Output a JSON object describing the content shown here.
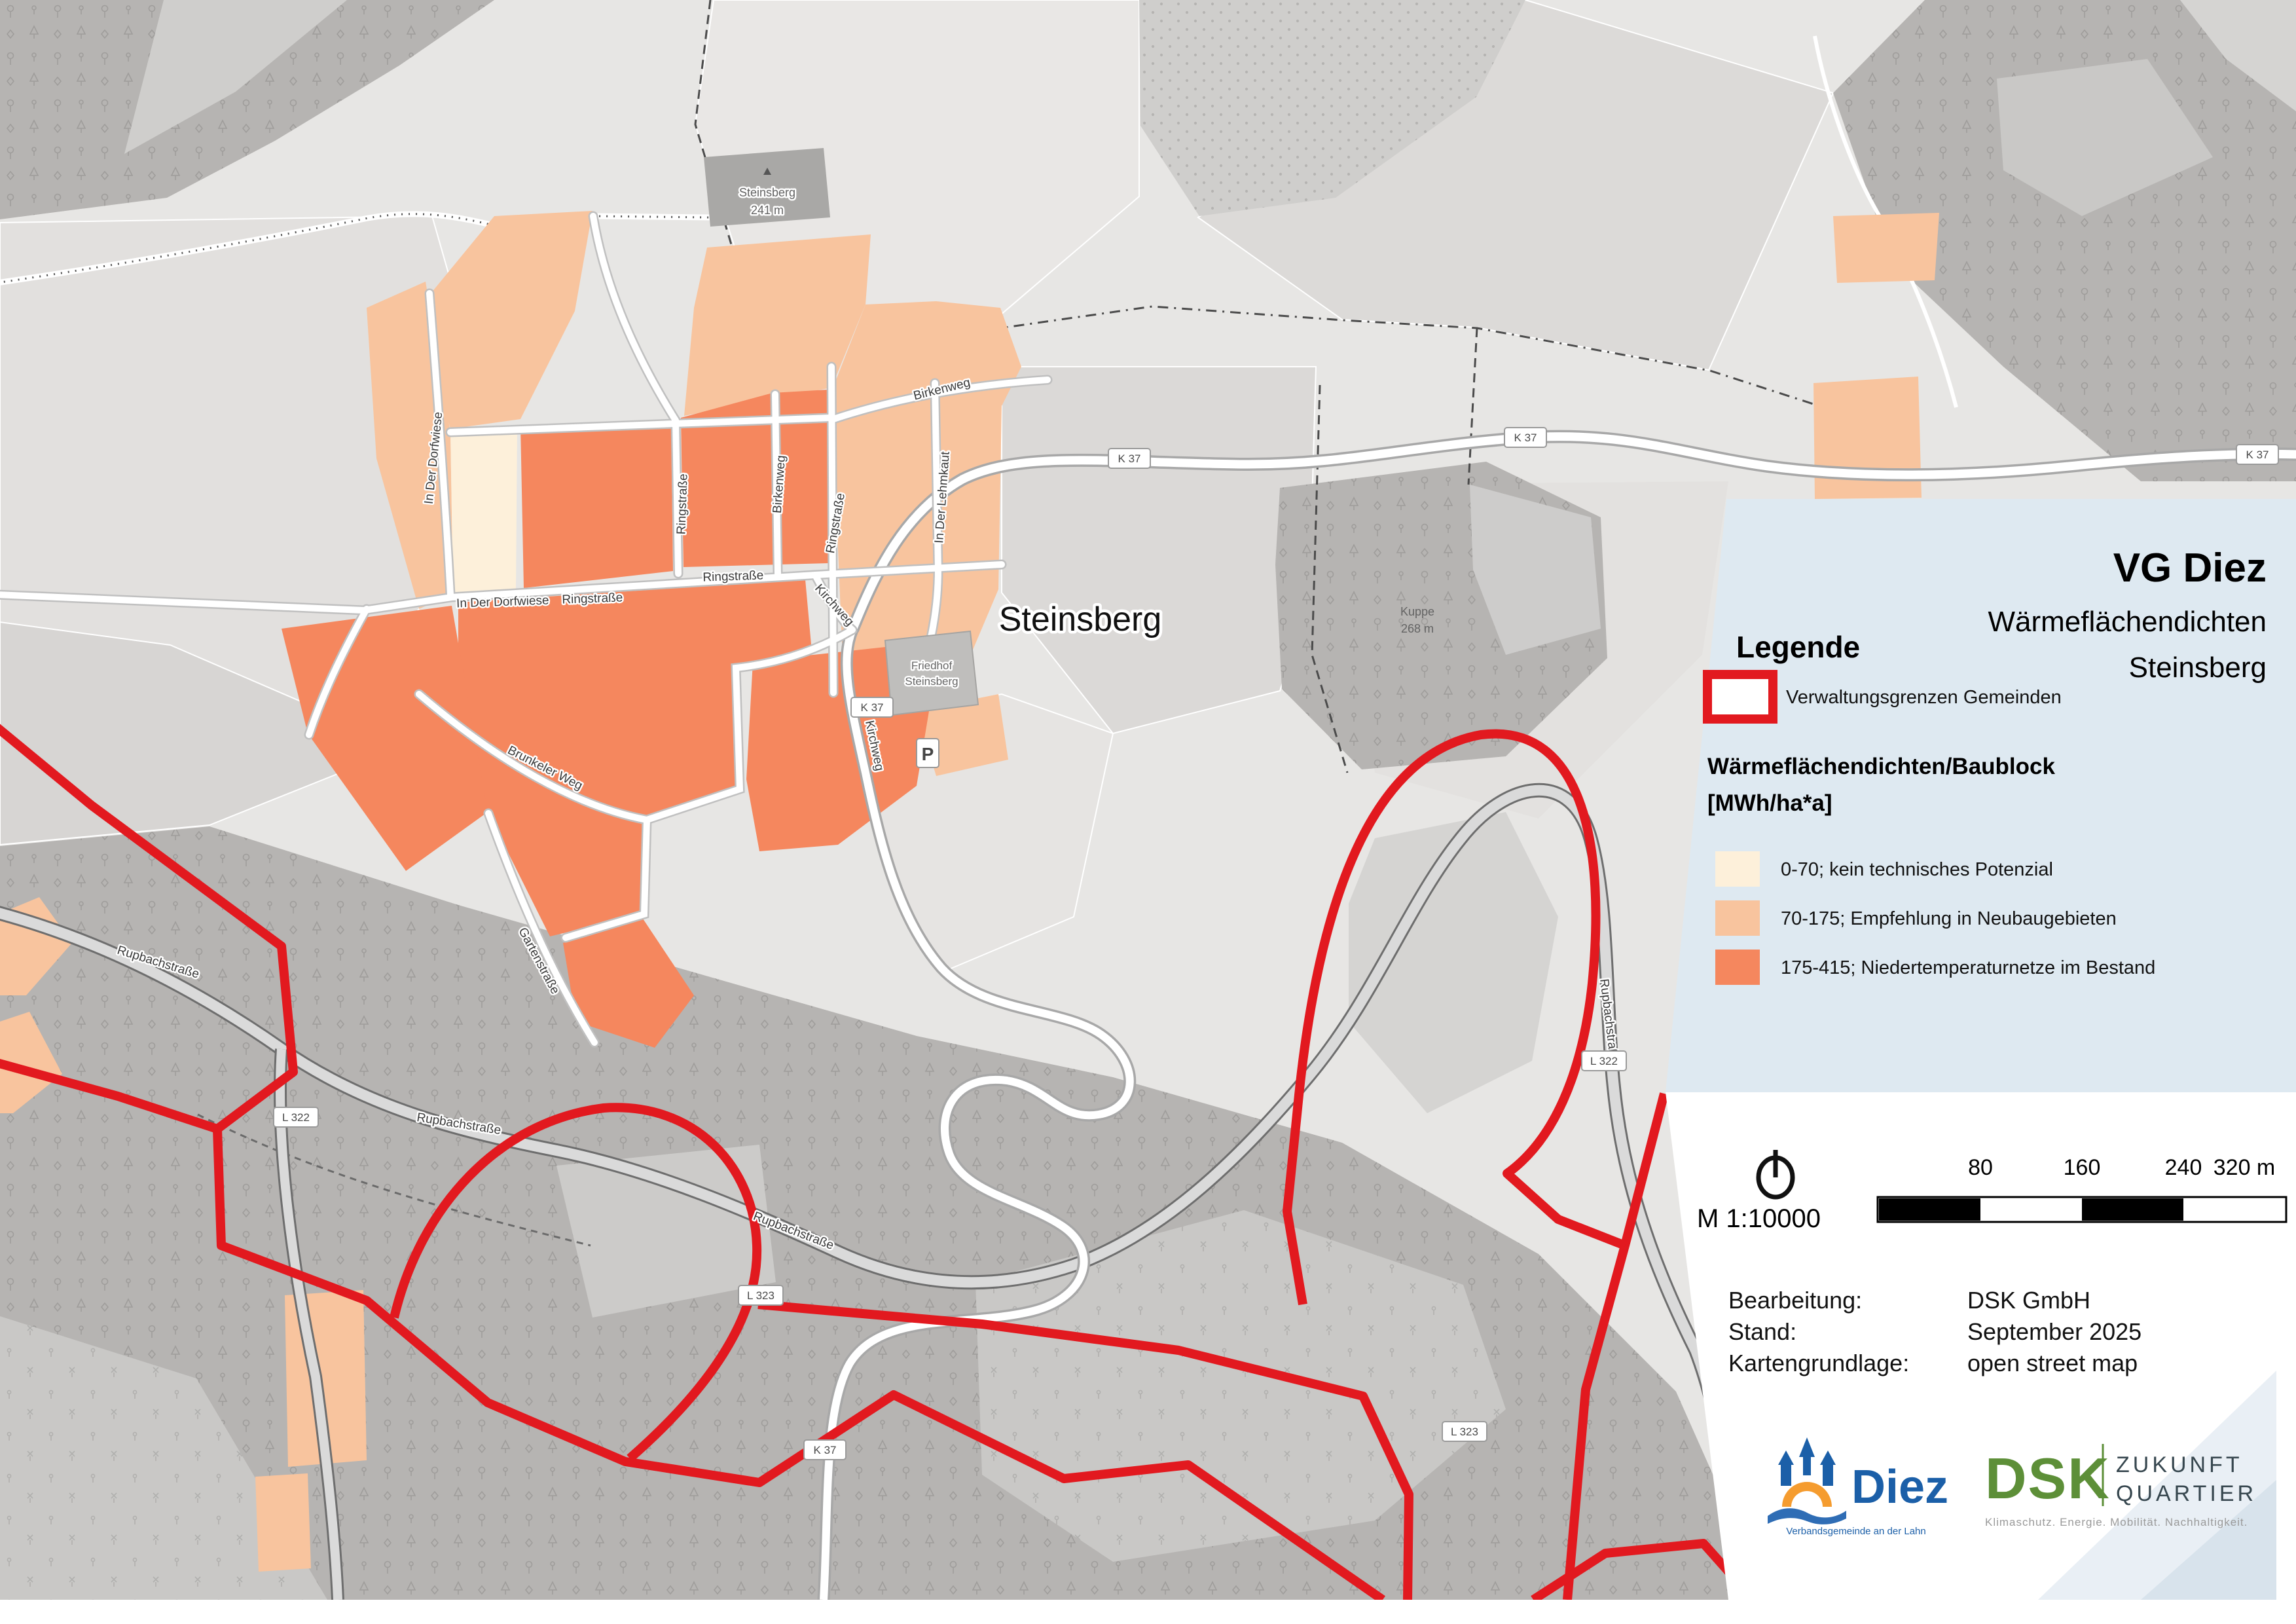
{
  "map": {
    "place_labels": {
      "town": "Steinsberg",
      "summit_name": "Steinsberg",
      "summit_elev": "241 m",
      "hill_name": "Kuppe",
      "hill_elev": "268 m",
      "cemetery_1": "Friedhof",
      "cemetery_2": "Steinsberg",
      "parking": "P"
    },
    "street_labels": [
      {
        "text": "In Der Dorfwiese"
      },
      {
        "text": "In Der Dorfwiese"
      },
      {
        "text": "Ringstraße"
      },
      {
        "text": "Ringstraße"
      },
      {
        "text": "Ringstraße"
      },
      {
        "text": "Ringstraße"
      },
      {
        "text": "Birkenweg"
      },
      {
        "text": "Birkenweg"
      },
      {
        "text": "In Der Lehmkaut"
      },
      {
        "text": "Kirchweg"
      },
      {
        "text": "Kirchweg"
      },
      {
        "text": "Brunkeler Weg"
      },
      {
        "text": "Gartenstraße"
      },
      {
        "text": "Rupbachstraße"
      },
      {
        "text": "Rupbachstraße"
      },
      {
        "text": "Rupbachstraße"
      },
      {
        "text": "Rupbachstraße"
      }
    ],
    "road_shields": [
      {
        "text": "K 37"
      },
      {
        "text": "K 37"
      },
      {
        "text": "K 37"
      },
      {
        "text": "K 37"
      },
      {
        "text": "K 37"
      },
      {
        "text": "L 322"
      },
      {
        "text": "L 322"
      },
      {
        "text": "L 323"
      },
      {
        "text": "L 323"
      }
    ],
    "colors": {
      "boundary_red": "#e2191f",
      "forest_gray": "#b6b4b2",
      "field_gray": "#e7e6e4",
      "road_white": "#ffffff"
    }
  },
  "panel": {
    "title": "VG Diez",
    "subtitle": "Wärmeflächendichten",
    "area": "Steinsberg",
    "legend_heading": "Legende",
    "boundary_label": "Verwaltungsgrenzen Gemeinden",
    "section_title_line1": "Wärmeflächendichten/Baublock",
    "section_title_line2": "[MWh/ha*a]",
    "background_color": "#dee9f1",
    "classes": [
      {
        "label": "0-70; kein technisches Potenzial",
        "color": "#fdf0da"
      },
      {
        "label": "70-175; Empfehlung in Neubaugebieten",
        "color": "#f8c49e"
      },
      {
        "label": "175-415; Niedertemperaturnetze im Bestand",
        "color": "#f5875e"
      }
    ]
  },
  "scalebar": {
    "scale_text": "M 1:10000",
    "ticks": [
      "80",
      "160",
      "240",
      "320 m"
    ]
  },
  "credits": {
    "rows": [
      {
        "label": "Bearbeitung:",
        "value": "DSK GmbH"
      },
      {
        "label": "Stand:",
        "value": "September 2025"
      },
      {
        "label": "Kartengrundlage:",
        "value": "open street map"
      }
    ]
  },
  "logos": {
    "diez": {
      "name": "Diez",
      "tagline": "Verbandsgemeinde an der Lahn",
      "blue": "#1b5fa8",
      "orange": "#f59c2f"
    },
    "dsk": {
      "name": "DSK",
      "claim1": "ZUKUNFT",
      "claim2": "QUARTIER",
      "tagline": "Klimaschutz. Energie. Mobilität. Nachhaltigkeit.",
      "green": "#5d8f38"
    }
  }
}
